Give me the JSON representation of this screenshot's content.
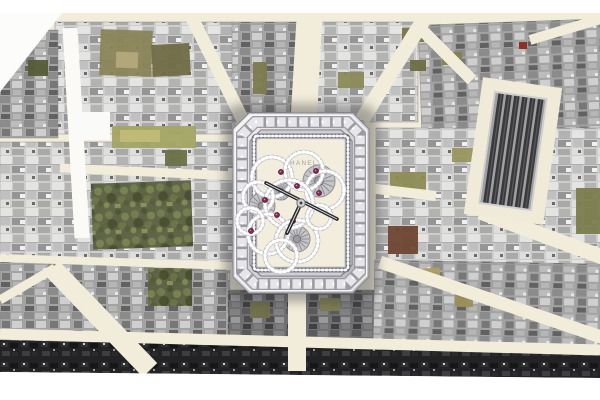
{
  "scene": {
    "description": "Aerial photographic map of Paris streets radiating from a central square, rendered in greyscale with cream streets and olive-green garden courtyards; a jeweled rectangular skeleton wristwatch with a diamond camellia-flower movement is superimposed at the center of the square. White margins at top and bottom.",
    "city_style": "aerial-photo-mosaic",
    "overlay": "diamond-skeleton-watch"
  },
  "canvas": {
    "width": 600,
    "height": 400,
    "top_white_band_h": 13,
    "bottom_white_from_y": 372
  },
  "palette": {
    "paper_white": "#ffffff",
    "street_cream": "#f2ecda",
    "bright_street": "#fbfaf6",
    "building_light": "#cdcdcd",
    "building_mid": "#a2a2a2",
    "building_darkish": "#6e6e70",
    "building_night": "#232325",
    "garden_olive": "#7c7b4d",
    "garden_trees": "#5a6040",
    "watch_silver": "#d9d9de",
    "dial_cream": "#f2eddc",
    "ruby": "#952a5d",
    "hand_dark": "#2c2c30"
  },
  "map": {
    "street_color": "#f2ecda",
    "bright_street_color": "#fbfaf6",
    "blocks": [
      {
        "x": 55,
        "y": 22,
        "w": 180,
        "h": 112,
        "tone": "light",
        "rot": 0
      },
      {
        "x": 0,
        "y": 30,
        "w": 58,
        "h": 108,
        "tone": "mid",
        "rot": 0
      },
      {
        "x": 232,
        "y": 22,
        "w": 70,
        "h": 100,
        "tone": "mid",
        "rot": 0
      },
      {
        "x": 300,
        "y": 22,
        "w": 118,
        "h": 100,
        "tone": "light",
        "rot": 0
      },
      {
        "x": 420,
        "y": 22,
        "w": 182,
        "h": 113,
        "tone": "mid",
        "rot": -2
      },
      {
        "x": 0,
        "y": 142,
        "w": 235,
        "h": 122,
        "tone": "light",
        "rot": 0
      },
      {
        "x": 376,
        "y": 128,
        "w": 226,
        "h": 140,
        "tone": "light",
        "rot": 0
      },
      {
        "x": 0,
        "y": 262,
        "w": 230,
        "h": 82,
        "tone": "mid",
        "rot": 0
      },
      {
        "x": 228,
        "y": 290,
        "w": 148,
        "h": 50,
        "tone": "darkish",
        "rot": 0
      },
      {
        "x": 374,
        "y": 262,
        "w": 228,
        "h": 82,
        "tone": "mid",
        "rot": 1
      }
    ],
    "streets": [
      {
        "x1": 303,
        "y1": 130,
        "x2": 310,
        "y2": 10,
        "w": 26,
        "bright": false
      },
      {
        "x1": 243,
        "y1": 120,
        "x2": 186,
        "y2": 6,
        "w": 13,
        "bright": false
      },
      {
        "x1": 362,
        "y1": 120,
        "x2": 432,
        "y2": 6,
        "w": 15,
        "bright": false
      },
      {
        "x1": 236,
        "y1": 176,
        "x2": 60,
        "y2": 168,
        "w": 9,
        "bright": false
      },
      {
        "x1": 420,
        "y1": 28,
        "x2": 472,
        "y2": 80,
        "w": 12,
        "bright": false
      },
      {
        "x1": 530,
        "y1": 40,
        "x2": 604,
        "y2": 18,
        "w": 10,
        "bright": false
      },
      {
        "x1": 368,
        "y1": 188,
        "x2": 436,
        "y2": 196,
        "w": 10,
        "bright": false
      },
      {
        "x1": 480,
        "y1": 212,
        "x2": 605,
        "y2": 258,
        "w": 15,
        "bright": false
      },
      {
        "x1": 380,
        "y1": 262,
        "x2": 604,
        "y2": 338,
        "w": 13,
        "bright": false
      },
      {
        "x1": 52,
        "y1": 268,
        "x2": 150,
        "y2": 370,
        "w": 20,
        "bright": false
      },
      {
        "x1": 0,
        "y1": 258,
        "x2": 232,
        "y2": 266,
        "w": 8,
        "bright": false
      },
      {
        "x1": 0,
        "y1": 300,
        "x2": 55,
        "y2": 268,
        "w": 9,
        "bright": false
      },
      {
        "x1": 0,
        "y1": 334,
        "x2": 600,
        "y2": 350,
        "w": 11,
        "bright": false
      },
      {
        "x1": 297,
        "y1": 292,
        "x2": 297,
        "y2": 371,
        "w": 18,
        "bright": false
      },
      {
        "x1": 70,
        "y1": 28,
        "x2": 82,
        "y2": 238,
        "w": 15,
        "bright": true
      }
    ],
    "dark_edge_band": {
      "points": "0,340 600,354 600,378 0,372"
    },
    "gardens": [
      {
        "x": 92,
        "y": 182,
        "w": 100,
        "h": 66,
        "fill": "trees",
        "rot": -2
      },
      {
        "x": 148,
        "y": 268,
        "w": 44,
        "h": 38,
        "fill": "trees",
        "rot": 0
      },
      {
        "x": 112,
        "y": 126,
        "w": 84,
        "h": 22,
        "fill": "#a3a464",
        "rot": 0
      },
      {
        "x": 120,
        "y": 130,
        "w": 40,
        "h": 12,
        "fill": "#c0ba78",
        "rot": 0
      },
      {
        "x": 100,
        "y": 30,
        "w": 52,
        "h": 46,
        "fill": "#8a8458",
        "rot": 2
      },
      {
        "x": 152,
        "y": 44,
        "w": 38,
        "h": 32,
        "fill": "#6f6b45",
        "rot": -3
      },
      {
        "x": 116,
        "y": 52,
        "w": 22,
        "h": 16,
        "fill": "#b3a97b",
        "rot": 2
      },
      {
        "x": 28,
        "y": 60,
        "w": 20,
        "h": 16,
        "fill": "#565c36",
        "rot": 0
      },
      {
        "x": 165,
        "y": 150,
        "w": 22,
        "h": 16,
        "fill": "#6b7046",
        "rot": 0
      },
      {
        "x": 253,
        "y": 62,
        "w": 14,
        "h": 32,
        "fill": "#7c7b4d",
        "rot": 0
      },
      {
        "x": 338,
        "y": 72,
        "w": 26,
        "h": 16,
        "fill": "#8b8a57",
        "rot": 0
      },
      {
        "x": 402,
        "y": 28,
        "w": 22,
        "h": 14,
        "fill": "#77764a",
        "rot": 0
      },
      {
        "x": 442,
        "y": 52,
        "w": 20,
        "h": 13,
        "fill": "#84824f",
        "rot": 0
      },
      {
        "x": 410,
        "y": 60,
        "w": 16,
        "h": 11,
        "fill": "#6d6c44",
        "rot": 0
      },
      {
        "x": 390,
        "y": 172,
        "w": 36,
        "h": 24,
        "fill": "#8d8c55",
        "rot": 0
      },
      {
        "x": 576,
        "y": 188,
        "w": 26,
        "h": 46,
        "fill": "#7b7c4e",
        "rot": 0
      },
      {
        "x": 452,
        "y": 148,
        "w": 22,
        "h": 14,
        "fill": "#9a9660",
        "rot": 0
      },
      {
        "x": 388,
        "y": 226,
        "w": 30,
        "h": 28,
        "fill": "#6f4532",
        "rot": 0
      },
      {
        "x": 250,
        "y": 302,
        "w": 20,
        "h": 16,
        "fill": "#70704a",
        "rot": 0
      },
      {
        "x": 320,
        "y": 298,
        "w": 20,
        "h": 13,
        "fill": "#7d7c50",
        "rot": 0
      },
      {
        "x": 420,
        "y": 268,
        "w": 20,
        "h": 13,
        "fill": "#ac9f63",
        "rot": -6
      },
      {
        "x": 455,
        "y": 295,
        "w": 18,
        "h": 12,
        "fill": "#998f57",
        "rot": 0
      }
    ],
    "white_patches": [
      {
        "type": "poly",
        "points": "0,13 62,13 0,92",
        "fill": "#fcfcfa"
      },
      {
        "type": "rect",
        "x": 72,
        "y": 112,
        "w": 38,
        "h": 28,
        "fill": "#fafaf8"
      }
    ],
    "red_roof": {
      "x": 519,
      "y": 42,
      "w": 8,
      "h": 7,
      "color": "#8c2f24"
    },
    "landmark_striped_building": {
      "rot": 8,
      "cx": 513,
      "cy": 151,
      "apron": {
        "x": 473,
        "y": 82,
        "w": 80,
        "h": 138,
        "color": "#f0ead8"
      },
      "core": {
        "x": 487,
        "y": 95,
        "w": 52,
        "h": 112,
        "frame": "#cfcfcf"
      }
    }
  },
  "watch": {
    "brand": "CHANEL",
    "colors": {
      "case_hi": "#f2f2f5",
      "case_lo": "#b4b4bb",
      "rim": "#f8f8fa",
      "baguette_base": "#9b9ba1",
      "baguette_stone": "#e6e6ea",
      "step_light": "#cfcfd4",
      "step_dark": "#84848a",
      "bead_base": "#62626a",
      "bead_dot": "#f6f6f8",
      "dial": "#f2eddc",
      "petal_base": "#bfbfc6",
      "petal_dot": "#ffffff",
      "gear": "#c6c6ca",
      "gear_edge": "#8a8a90",
      "ruby": "#952a5d",
      "ruby_rim": "#4f0e2c",
      "hand": "#2c2c30",
      "hand_slit": "#e8e8ea",
      "brand_text": "#9c9b97",
      "shadow": "#3a3a3c"
    },
    "case": {
      "x": 233,
      "y": 113,
      "w": 136,
      "h": 180,
      "chamfer": 16
    },
    "dial_rect": {
      "x": 257.5,
      "y": 139.5,
      "w": 87,
      "h": 127
    },
    "bead_rect": {
      "x": 254,
      "y": 136,
      "w": 94,
      "h": 134
    },
    "petals": [
      {
        "cx": 272,
        "cy": 177,
        "r": 20
      },
      {
        "cx": 304,
        "cy": 171,
        "r": 19
      },
      {
        "cx": 325,
        "cy": 190,
        "r": 19
      },
      {
        "cx": 258,
        "cy": 197,
        "r": 15
      },
      {
        "cx": 289,
        "cy": 204,
        "r": 24
      },
      {
        "cx": 268,
        "cy": 234,
        "r": 20
      },
      {
        "cx": 297,
        "cy": 241,
        "r": 21
      },
      {
        "cx": 250,
        "cy": 221,
        "r": 13
      },
      {
        "cx": 281,
        "cy": 256,
        "r": 16
      },
      {
        "cx": 319,
        "cy": 217,
        "r": 12
      }
    ],
    "gears": [
      {
        "cx": 319,
        "cy": 181,
        "r": 16
      },
      {
        "cx": 262,
        "cy": 206,
        "r": 13
      },
      {
        "cx": 297,
        "cy": 239,
        "r": 13
      },
      {
        "cx": 281,
        "cy": 191,
        "r": 9
      }
    ],
    "rubies": [
      {
        "cx": 281,
        "cy": 172
      },
      {
        "cx": 316,
        "cy": 171
      },
      {
        "cx": 319,
        "cy": 193
      },
      {
        "cx": 265,
        "cy": 200
      },
      {
        "cx": 277,
        "cy": 215
      },
      {
        "cx": 293,
        "cy": 221
      },
      {
        "cx": 251,
        "cy": 231
      },
      {
        "cx": 297,
        "cy": 186
      }
    ],
    "center": {
      "cx": 301,
      "cy": 203
    },
    "hands": {
      "long": {
        "x1": 266,
        "y1": 183,
        "x2": 337,
        "y2": 219
      },
      "hour": {
        "x1": 301,
        "y1": 203,
        "x2": 287,
        "y2": 233
      }
    }
  }
}
